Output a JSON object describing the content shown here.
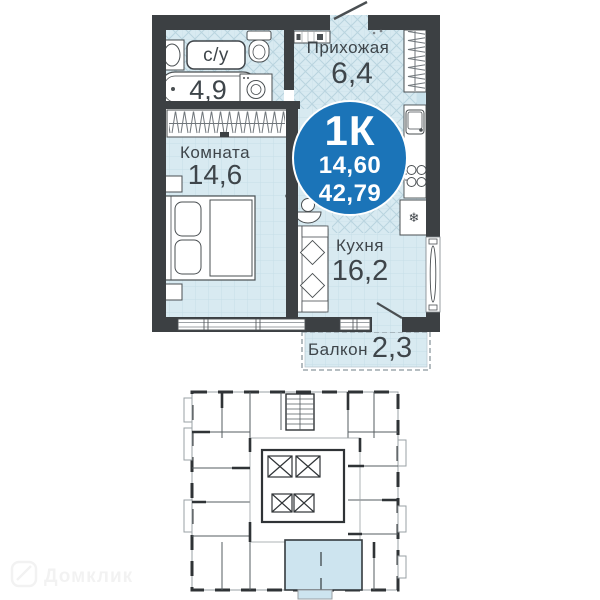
{
  "apartment": {
    "badge": {
      "rooms_label": "1К",
      "living_area": "14,60",
      "total_area": "42,79"
    },
    "rooms": {
      "hallway": {
        "name": "Прихожая",
        "area": "6,4"
      },
      "bathroom": {
        "name": "с/у",
        "area": "4,9"
      },
      "living_room": {
        "name": "Комната",
        "area": "14,6"
      },
      "kitchen": {
        "name": "Кухня",
        "area": "16,2"
      },
      "balcony": {
        "name": "Балкон",
        "area": "2,3"
      }
    }
  },
  "icons": {
    "fridge_snowflake": "❄"
  },
  "watermark": {
    "text": "Домклик"
  },
  "colors": {
    "badge_blue": "#1b74b8",
    "wall_dark": "#3c4043",
    "floor_light_blue": "#d8eaf1",
    "highlighted_unit": "#cde4ef"
  }
}
